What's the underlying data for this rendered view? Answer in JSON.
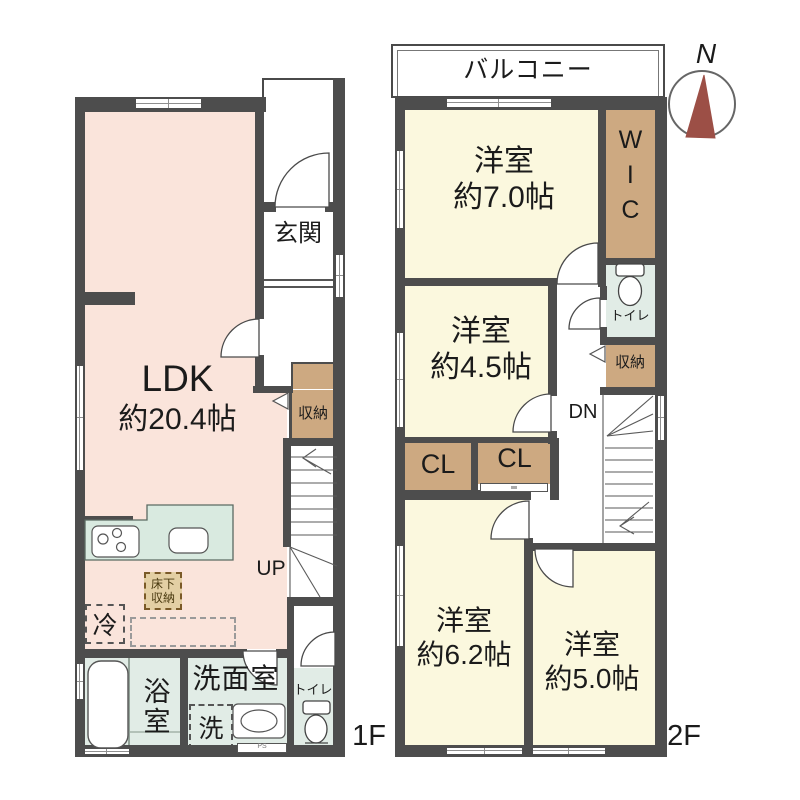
{
  "floor1": {
    "floor_label": "1F",
    "ldk_name": "LDK",
    "ldk_size": "約20.4帖",
    "entrance": "玄関",
    "closet": "収納",
    "underfloor_storage": "床下\n収納",
    "fridge": "冷",
    "stairs_up": "UP",
    "bath": "浴室",
    "washroom": "洗面室",
    "washer": "洗",
    "toilet": "トイレ",
    "pipe_space": "PS"
  },
  "floor2": {
    "floor_label": "2F",
    "balcony": "バルコニー",
    "room7_name": "洋室",
    "room7_size": "約7.0帖",
    "wic": "WIC",
    "toilet": "トイレ",
    "closet": "収納",
    "room45_name": "洋室",
    "room45_size": "約4.5帖",
    "closet_left": "CL",
    "closet_right": "CL",
    "stairs_down": "DN",
    "room62_name": "洋室",
    "room62_size": "約6.2帖",
    "room50_name": "洋室",
    "room50_size": "約5.0帖"
  },
  "compass": {
    "north": "N"
  },
  "colors": {
    "wall": "#4D4D4D",
    "ldk": "#FAE4DB",
    "room": "#FBF8DE",
    "closet": "#CDA981",
    "wet": "#E1ECE6",
    "kitchen": "#D9EAE0",
    "north": "#9C4F46",
    "line": "#4A4A4A"
  }
}
